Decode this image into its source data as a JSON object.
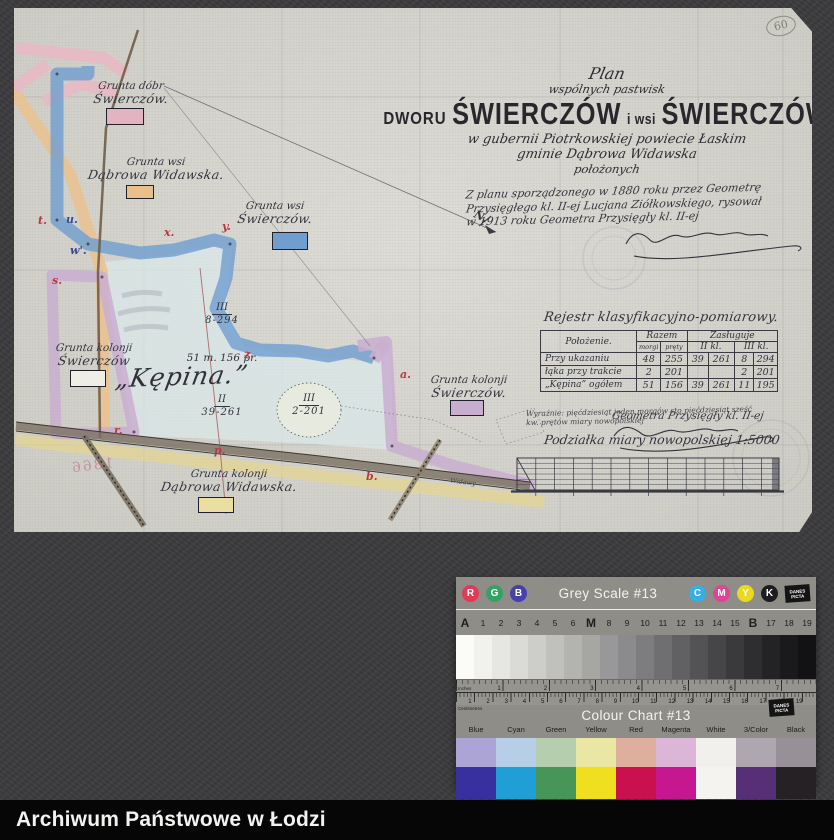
{
  "archive_bar": {
    "title": "Archiwum Państwowe w Łodzi"
  },
  "page_number": "60",
  "plan": {
    "title_script1": "Plan",
    "title_script2": "wspólnych pastwisk",
    "title_main": {
      "prefix": "DWORU",
      "name1": "ŚWIERCZÓW",
      "mid": "i wsi",
      "name2": "ŚWIERCZÓW"
    },
    "subtitle1": "w gubernii Piotrkowskiej powiecie Łaskim",
    "subtitle2": "gminie Dąbrowa Widawska",
    "subtitle3": "położonych",
    "provenance_lines": [
      "Z planu sporządzonego w 1880 roku przez Geometrę",
      "Przysięgłego kl. II-ej Lucjana Ziółkowskiego, rysował",
      "w 1913 roku Geometra Przysięgły kl. II-ej"
    ],
    "land_labels": [
      {
        "line1": "Grunta dóbr",
        "line2": "Świerczów.",
        "swatch_color": "#e4b3c1"
      },
      {
        "line1": "Grunta wsi",
        "line2": "Dąbrowa Widawska.",
        "swatch_color": "#e9c08c"
      },
      {
        "line1": "Grunta wsi",
        "line2": "Świerczów.",
        "swatch_color": "#6f9ecf"
      },
      {
        "line1": "Grunta kolonji",
        "line2": "Świerczów",
        "swatch_color": "#eeeee6"
      },
      {
        "line1": "Grunta kolonji",
        "line2": "Świerczów.",
        "swatch_color": "#c9aed0"
      },
      {
        "line1": "Grunta kolonji",
        "line2": "Dąbrowa Widawska.",
        "swatch_color": "#eadfa0"
      }
    ],
    "parcel": {
      "name": "„Kępina.”",
      "area": "51 m. 156 pr.",
      "class_marks": [
        {
          "cls": "III",
          "value": "8-294"
        },
        {
          "cls": "II",
          "value": "39-261"
        },
        {
          "cls": "III",
          "value": "2-201"
        }
      ]
    },
    "boundary_letters": [
      "t.",
      "u.",
      "w'.",
      "s.",
      "x.",
      "y.",
      "z.",
      "r.",
      "p.",
      "a.",
      "b."
    ],
    "north_label": "N.",
    "road_label": "Widawy",
    "mirror_note": "1866",
    "register": {
      "title": "Rejestr klasyfikacyjno-pomiarowy.",
      "columns": {
        "place": "Położenie.",
        "total": "Razem",
        "breakdown": "Zasługuje",
        "cls2": "II kl.",
        "cls3": "III kl.",
        "unit_m": "morgi",
        "unit_p": "pręty"
      },
      "rows": [
        {
          "place": "Przy ukazaniu",
          "total_m": "48",
          "total_p": "255",
          "cls2_m": "39",
          "cls2_p": "261",
          "cls3_m": "8",
          "cls3_p": "294"
        },
        {
          "place": "łąka przy trakcie",
          "total_m": "2",
          "total_p": "201",
          "cls2_m": "",
          "cls2_p": "",
          "cls3_m": "2",
          "cls3_p": "201"
        },
        {
          "place": "„Kępina” ogółem",
          "total_m": "51",
          "total_p": "156",
          "cls2_m": "39",
          "cls2_p": "261",
          "cls3_m": "11",
          "cls3_p": "195"
        }
      ],
      "note_line1": "Wyraźnie: pięćdziesiąt jeden morgów sto pięćdziesiąt sześć",
      "note_line2": "kw. prętów miary nowopolskiej",
      "surveyor_line": "Geometra Przysięgły kl. II-ej"
    },
    "scale_caption": "Podziałka miary nowopolskiej 1:5000"
  },
  "color_card": {
    "grey_scale_title": "Grey Scale #13",
    "colour_chart_title": "Colour Chart #13",
    "rgb_circles": [
      {
        "letter": "R",
        "color": "#e23a55"
      },
      {
        "letter": "G",
        "color": "#35a265"
      },
      {
        "letter": "B",
        "color": "#4740ad"
      }
    ],
    "cmyk_circles": [
      {
        "letter": "C",
        "color": "#35aee4"
      },
      {
        "letter": "M",
        "color": "#de4597"
      },
      {
        "letter": "Y",
        "color": "#ead91f"
      },
      {
        "letter": "K",
        "color": "#1d1d1f"
      }
    ],
    "logo_lines": [
      "DANES",
      "PICTA"
    ],
    "index_labels": [
      "A",
      "1",
      "2",
      "3",
      "4",
      "5",
      "6",
      "M",
      "8",
      "9",
      "10",
      "11",
      "12",
      "13",
      "14",
      "15",
      "B",
      "17",
      "18",
      "19"
    ],
    "grey_steps": [
      "#fbfbf8",
      "#f1f1ee",
      "#e6e6e3",
      "#dadad7",
      "#cdcdca",
      "#c0c0bd",
      "#b3b3b0",
      "#a6a6a3",
      "#98989b",
      "#8b8b8e",
      "#7d7d80",
      "#6f6f72",
      "#616164",
      "#535356",
      "#464649",
      "#3a3a3d",
      "#2e2e31",
      "#232326",
      "#1a1a1d",
      "#121215"
    ],
    "ruler": {
      "inches_label": "Inches",
      "cm_label": "Centimetres",
      "inch_numbers": [
        "1",
        "2",
        "3",
        "4",
        "5",
        "6",
        "7"
      ],
      "cm_numbers": [
        "1",
        "2",
        "3",
        "4",
        "5",
        "6",
        "7",
        "8",
        "9",
        "10",
        "11",
        "12",
        "13",
        "14",
        "15",
        "16",
        "17",
        "18",
        "19"
      ]
    },
    "color_columns": [
      {
        "label": "Blue",
        "light": "#aca4d4",
        "full": "#38309e"
      },
      {
        "label": "Cyan",
        "light": "#b7cfe6",
        "full": "#1f9fd6"
      },
      {
        "label": "Green",
        "light": "#b5cfae",
        "full": "#479657"
      },
      {
        "label": "Yellow",
        "light": "#eae6a4",
        "full": "#efdf1e"
      },
      {
        "label": "Red",
        "light": "#dfaf9e",
        "full": "#cb1050"
      },
      {
        "label": "Magenta",
        "light": "#dcb6d6",
        "full": "#c71790"
      },
      {
        "label": "White",
        "light": "#f2f0ec",
        "full": "#f5f3ef"
      },
      {
        "label": "3/Color",
        "light": "#afa7af",
        "full": "#572f77"
      },
      {
        "label": "Black",
        "light": "#979097",
        "full": "#252125"
      }
    ]
  }
}
